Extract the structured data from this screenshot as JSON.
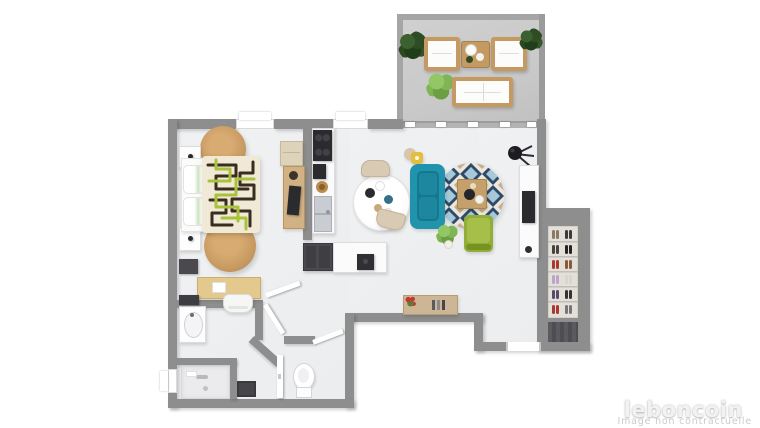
{
  "watermark": {
    "brand": "leboncoin",
    "disclaimer": "Image non contractuelle"
  },
  "palette": {
    "wall": "#8e8e8e",
    "floor": "#ebedef",
    "terrace_floor": "#c9c9c9",
    "terrace_wall": "#a5a5a5",
    "wood": "#c59a62",
    "jute": "#c89b62",
    "wood_desk": "#e4c98f",
    "sofa_teal": "#2293ad",
    "sofa_teal_dark": "#15788f",
    "chair_green": "#93ad3a",
    "chair_green_light": "#a5bf49",
    "plant_dark": "#2e4d24",
    "plant_light": "#7fb554",
    "rug_navy": "#2e4a6b",
    "rug_blue": "#a7c8d6",
    "rug_tan": "#c3b093",
    "rug_cream": "#ece7da",
    "bed_cream": "#efe9d6",
    "bed_dark": "#3a2d20",
    "bed_green": "#a9c23a",
    "appliance_dark": "#2b2b2f",
    "cabinet_dark": "#4a4a4e",
    "mat_dark": "#5b5b5f",
    "accent_red": "#c03a2e",
    "stool_yellow": "#e3bf3f",
    "brand_text": "#f2f2f2",
    "disclaimer_text": "#cbcbcb"
  }
}
